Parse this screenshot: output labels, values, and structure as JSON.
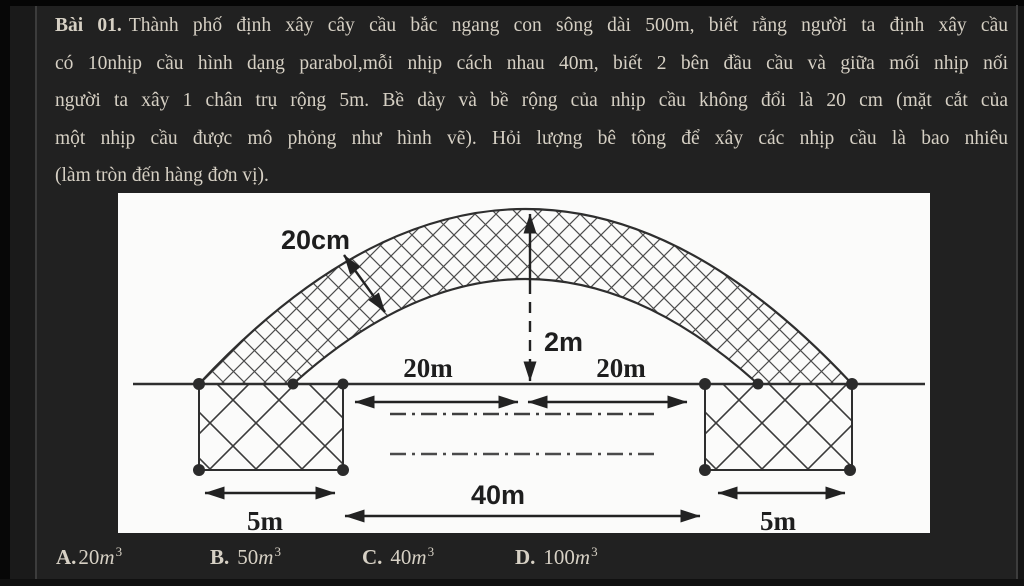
{
  "page": {
    "background": "#212121",
    "text_color": "#d6d0c4",
    "panel_color": "#fbfbfa"
  },
  "problem": {
    "label": "Bài 01.",
    "lines": [
      "Thành phố định xây cây cầu bắc ngang con sông dài 500m, biết rằng người ta định xây cầu",
      "có 10nhịp cầu hình dạng parabol,mỗi nhịp cách nhau 40m, biết 2 bên đầu cầu và giữa mối nhịp nối",
      "người ta xây 1 chân trụ rộng 5m. Bề dày và bề rộng của nhịp cầu không đổi là 20 cm (mặt cắt của",
      "một nhịp cầu được mô phỏng như hình vẽ). Hỏi lượng bê tông để xây các nhịp cầu là bao nhiêu",
      "(làm tròn đến hàng đơn vị)."
    ]
  },
  "figure": {
    "labels": {
      "thickness": "20cm",
      "rise": "2m",
      "half_span_left": "20m",
      "half_span_right": "20m",
      "span": "40m",
      "pier_left": "5m",
      "pier_right": "5m"
    },
    "ink_color": "#2e2e2e"
  },
  "answers": [
    {
      "letter": "A.",
      "number": "20",
      "unit": "m",
      "exponent": "3"
    },
    {
      "letter": "B.",
      "number": "50",
      "unit": "m",
      "exponent": "3"
    },
    {
      "letter": "C.",
      "number": "40",
      "unit": "m",
      "exponent": "3"
    },
    {
      "letter": "D.",
      "number": "100",
      "unit": "m",
      "exponent": "3"
    }
  ]
}
